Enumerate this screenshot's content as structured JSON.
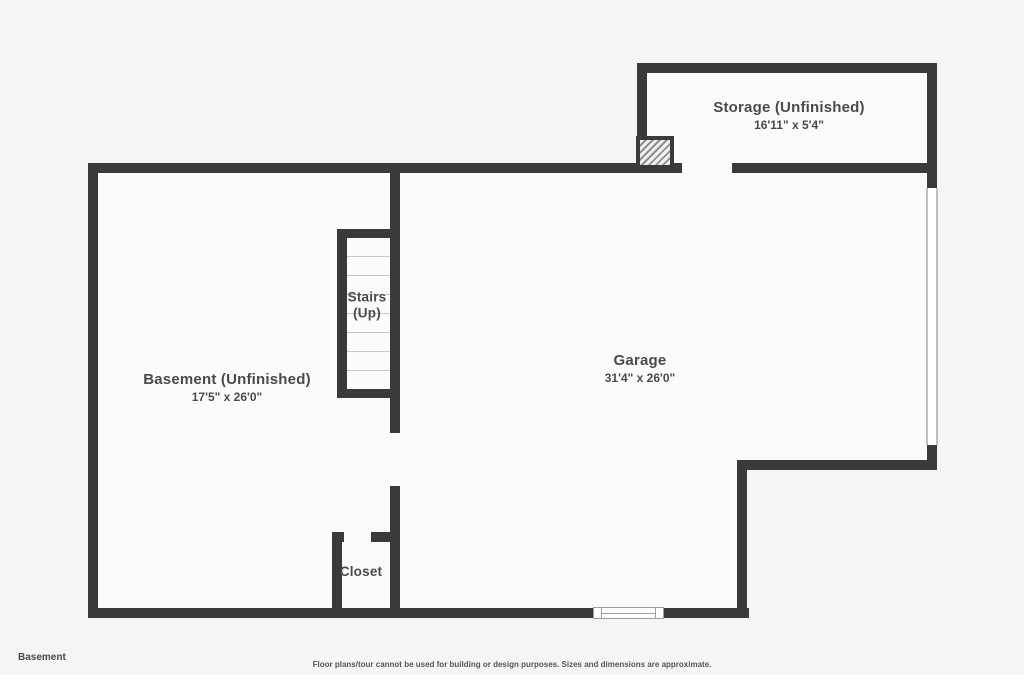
{
  "colors": {
    "wall": "#3a3a3a",
    "background": "#f5f5f5",
    "floor_fill": "#fbfbfb",
    "label_text": "#4a4a4a"
  },
  "rooms": {
    "storage": {
      "name": "Storage (Unfinished)",
      "dimensions": "16'11\" x 5'4\""
    },
    "basement": {
      "name": "Basement (Unfinished)",
      "dimensions": "17'5\" x 26'0\""
    },
    "garage": {
      "name": "Garage",
      "dimensions": "31'4\" x 26'0\""
    },
    "stairs": {
      "name": "Stairs",
      "direction": "(Up)"
    },
    "closet": {
      "name": "Closet"
    }
  },
  "footer": {
    "floor_label": "Basement",
    "disclaimer": "Floor plans/tour cannot be used for building or design purposes. Sizes and dimensions are approximate."
  }
}
